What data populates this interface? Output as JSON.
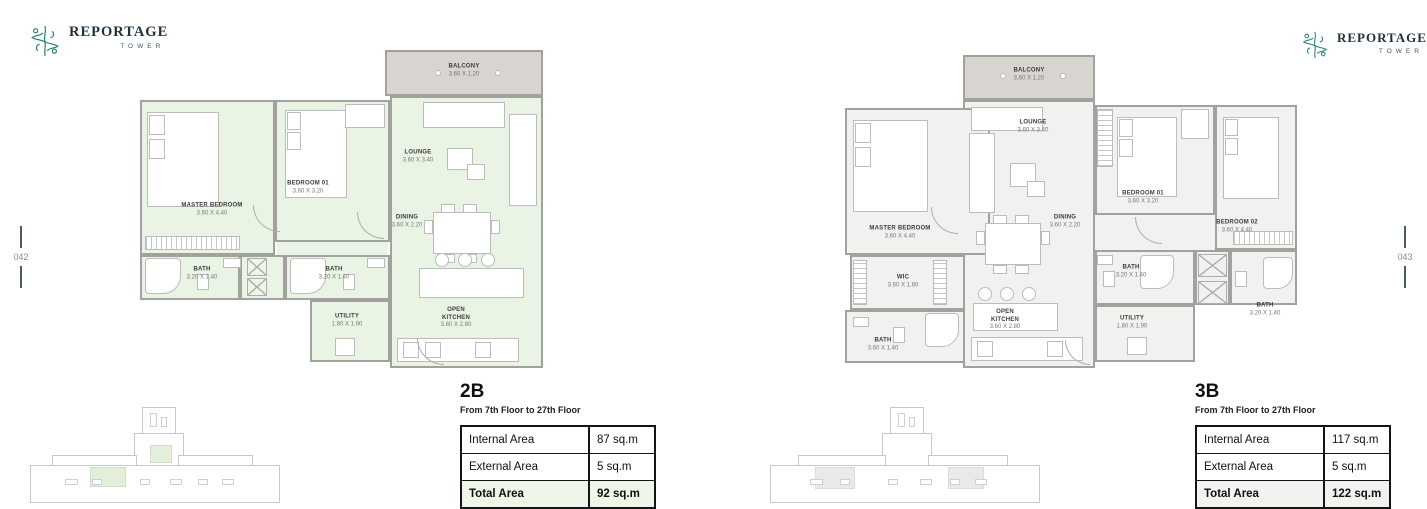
{
  "brand": {
    "name": "REPORTAGE",
    "sub": "TOWER"
  },
  "page_markers": {
    "left": "042",
    "right": "043"
  },
  "palette": {
    "plan_2b_tint": "#eaf4e4",
    "plan_3b_tint": "#f1f1ef",
    "balcony_fill": "#d8d5d0",
    "brand_teal": "#2e7e73",
    "total_row_2b": "#edf6e8",
    "total_row_3b": "#f2f2f1"
  },
  "units": [
    {
      "code": "2B",
      "floors": "From 7th Floor to 27th Floor",
      "rooms": {
        "balcony": {
          "name": "BALCONY",
          "dims": "3.60 X 1.20"
        },
        "master": {
          "name": "MASTER BEDROOM",
          "dims": "3.60 X 4.40"
        },
        "bedroom1": {
          "name": "BEDROOM 01",
          "dims": "3.60 X 3.20"
        },
        "lounge": {
          "name": "LOUNGE",
          "dims": "3.60 X 3.40"
        },
        "dining": {
          "name": "DINING",
          "dims": "3.60 X 2.20"
        },
        "bath1": {
          "name": "BATH",
          "dims": "3.20 X 1.40"
        },
        "bath2": {
          "name": "BATH",
          "dims": "3.20 X 1.40"
        },
        "utility": {
          "name": "UTILITY",
          "dims": "1.80 X 1.90"
        },
        "kitchen": {
          "name": "OPEN KITCHEN",
          "dims": "3.60 X 2.80"
        }
      },
      "area_table": {
        "rows": [
          {
            "label": "Internal Area",
            "value": "87 sq.m"
          },
          {
            "label": "External Area",
            "value": "5 sq.m"
          },
          {
            "label": "Total Area",
            "value": "92 sq.m"
          }
        ]
      }
    },
    {
      "code": "3B",
      "floors": "From 7th Floor to 27th Floor",
      "rooms": {
        "balcony": {
          "name": "BALCONY",
          "dims": "3.60 X 1.20"
        },
        "master": {
          "name": "MASTER BEDROOM",
          "dims": "3.60 X 4.40"
        },
        "lounge": {
          "name": "LOUNGE",
          "dims": "3.60 X 3.40"
        },
        "dining": {
          "name": "DINING",
          "dims": "3.60 X 2.20"
        },
        "bedroom1": {
          "name": "BEDROOM 01",
          "dims": "3.60 X 3.20"
        },
        "bedroom2": {
          "name": "BEDROOM 02",
          "dims": "3.60 X 4.40"
        },
        "wic": {
          "name": "WIC",
          "dims": "3.60 X 1.80"
        },
        "bath_master": {
          "name": "BATH",
          "dims": "3.60 X 1.40"
        },
        "bath1": {
          "name": "BATH",
          "dims": "3.20 X 1.40"
        },
        "bath2": {
          "name": "BATH",
          "dims": "3.20 X 1.40"
        },
        "utility": {
          "name": "UTILITY",
          "dims": "1.80 X 1.90"
        },
        "kitchen": {
          "name": "OPEN KITCHEN",
          "dims": "3.60 X 2.80"
        }
      },
      "area_table": {
        "rows": [
          {
            "label": "Internal Area",
            "value": "117 sq.m"
          },
          {
            "label": "External Area",
            "value": "5 sq.m"
          },
          {
            "label": "Total Area",
            "value": "122 sq.m"
          }
        ]
      }
    }
  ]
}
